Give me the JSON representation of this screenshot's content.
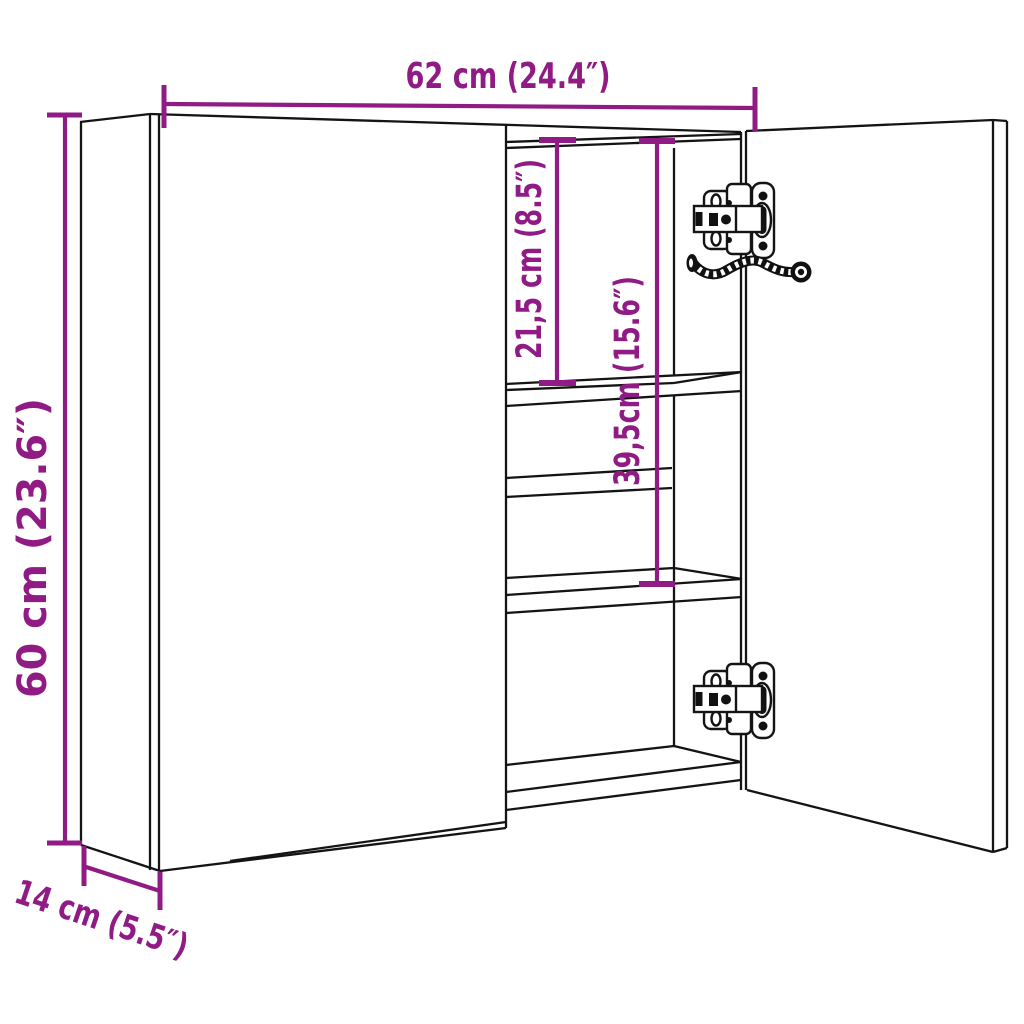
{
  "diagram": {
    "kind": "furniture-dimension-line-drawing",
    "accent_color": "#911B84",
    "line_color": "#141414",
    "background_color": "#FFFFFF",
    "labels": {
      "width": "62 cm (24.4″)",
      "height": "60 cm (23.6″)",
      "depth": "14 cm (5.5″)",
      "shelf_top_gap": "21,5 cm (8.5″)",
      "shelf_mid_gap": "39,5cm (15.6″)"
    }
  }
}
